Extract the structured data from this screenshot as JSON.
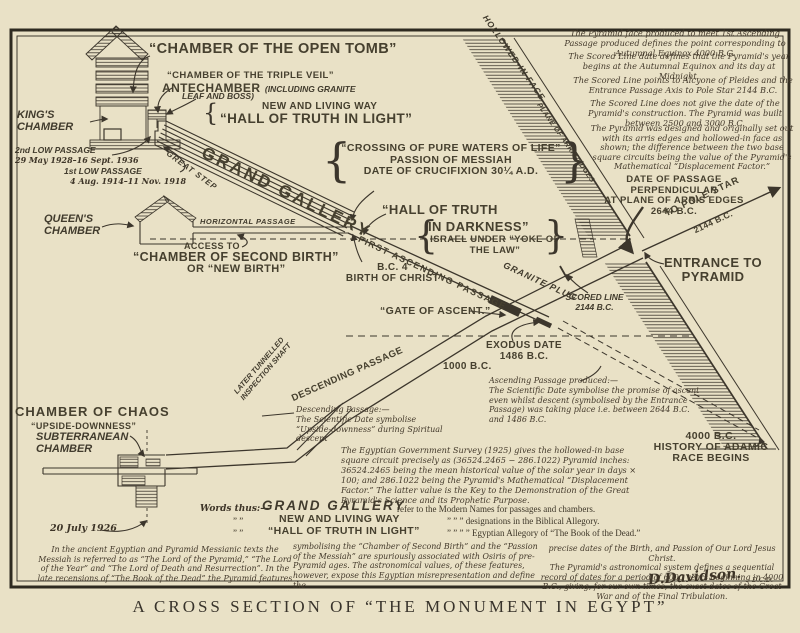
{
  "colors": {
    "paper": "#e9e1c6",
    "ink": "#3c362c"
  },
  "title": "A CROSS SECTION OF “THE MONUMENT IN EGYPT”",
  "glyphs": {
    "brace_open": "{",
    "brace_close": "}"
  },
  "labels": {
    "open_tomb": "“CHAMBER OF THE OPEN TOMB”",
    "triple_veil": "“CHAMBER OF THE TRIPLE VEIL”",
    "antechamber": "ANTECHAMBER",
    "antechamber_paren": "(INCLUDING GRANITE",
    "antechamber_paren2": "LEAF AND BOSS)",
    "new_living_way": "NEW AND LIVING WAY",
    "hall_light": "“HALL OF TRUTH IN LIGHT”",
    "kings_chamber": "KING'S\nCHAMBER",
    "low2": "2nd LOW PASSAGE",
    "low2_dates": "29 May 1928–16 Sept. 1936",
    "low1": "1st LOW PASSAGE",
    "low1_dates": "4 Aug. 1914–11 Nov. 1918",
    "great_step": "GREAT STEP",
    "grand_gallery": "GRAND GALLERY",
    "crossing": "“CROSSING OF PURE WATERS OF LIFE”\nPASSION OF MESSIAH\nDATE OF CRUCIFIXION 30¼ A.D.",
    "hollowed_face": "HOLLOWED-IN FACE",
    "plane_arris": "PLANE OF ARRIS EDGES",
    "date_perpendicular": "DATE OF PASSAGE PERPENDICULAR\nAT PLANE OF ARRIS EDGES\n2644 B.C.",
    "pole_star": "TO POLE STAR",
    "pole_star_date": "2144 B.C.",
    "entrance": "ENTRANCE TO\nPYRAMID",
    "queens_chamber": "QUEEN'S\nCHAMBER",
    "horizontal_passage": "HORIZONTAL PASSAGE",
    "access_to": "ACCESS TO",
    "second_birth": "“CHAMBER OF SECOND BIRTH”",
    "new_birth": "OR “NEW BIRTH”",
    "hall_darkness_1": "“HALL OF TRUTH",
    "hall_darkness_2": "IN DARKNESS”",
    "israel": "ISRAEL UNDER “YOKE OF\nTHE LAW”",
    "first_ascending": "FIRST ASCENDING PASSAGE",
    "bc4": "B.C. 4\nBIRTH OF CHRIST",
    "gate_of_ascent": "“GATE OF ASCENT.”",
    "granite_plug": "GRANITE PLUG",
    "scored_line": "SCORED LINE\n2144 B.C.",
    "exodus": "EXODUS DATE\n1486 B.C.",
    "bc1000": "1000 B.C.",
    "adamic": "4000 B.C.\nHISTORY OF ADAMIC\nRACE BEGINS",
    "descending_passage": "DESCENDING PASSAGE",
    "inspection_shaft": "LATER TUNNELLED\nINSPECTION SHAFT",
    "chamber_chaos": "CHAMBER OF CHAOS",
    "upside_downness": "“UPSIDE-DOWNNESS”",
    "subterranean": "SUBTERRANEAN\nCHAMBER",
    "date_1926": "20 July 1926"
  },
  "notes": {
    "n1": "The Pyramid face produced to meet 1st Ascending Passage produced defines the point corresponding to Autumnal Equinox 4000 B.C.",
    "n2": "The Scored Line date defines that the Pyramid's year begins at the Autumnal Equinox and its day at Midnight.",
    "n3": "The Scored Line points to Alcyone of Pleides and the Entrance Passage Axis to Pole Star 2144 B.C.",
    "n4": "The Scored Line does not give the date of the Pyramid's construction.  The Pyramid was built between 2500 and 3000 B.C.",
    "n5": "The Pyramid was designed and originally set out with its arris edges and hollowed-in face as shown; the difference between the two base square circuits being the value of the Pyramid's Mathematical “Displacement Factor.”",
    "ascending": "Ascending Passage produced:—\nThe Scientific Date symbolise the promise of ascent even whilst descent (symbolised by the Entrance Passage) was taking place i.e. between 2644 B.C. and 1486 B.C.",
    "descending": "Descending Passage:—\nThe Scientific Date symbolise\n“Upside-downness” during Spiritual descent",
    "survey": "The Egyptian Government Survey (1925) gives the hollowed-in base square circuit precisely as (36524.2465 − 286.1022) Pyramid inches:  36524.2465 being the mean historical value of the solar year in days × 100;  and 286.1022 being the Pyramid's Mathematical “Displacement Factor.”        The latter value is the Key to the Demonstration of the Great Pyramid's Science and its Prophetic Purpose.",
    "bottom_left": "In the ancient Egyptian and Pyramid Messianic texts the Messiah is referred to as “The Lord of the Pyramid,” “The Lord of the Year” and “The Lord of Death and Resurrection”.    In the late recensions of “The Book of the Dead” the Pyramid features",
    "bottom_mid": "symbolising the “Chamber of Second Birth” and the “Passion of the Messiah” are spuriously associated with Osiris of pre-Pyramid ages.   The astronomical values, of these features, however, expose this Egyptian misrepresentation and define the",
    "bottom_right": "precise dates of the Birth, and Passion of Our Lord Jesus Christ.\nThe Pyramid's astronomical system defines a sequential record of dates for a period of 6000 years beginning in 4000 B.C., giving, for our own times, the exact dates of the Great War and of the Final Tribulation.",
    "signature": "D.Davidson.",
    "signature_initials": "D.C.D."
  },
  "legend": {
    "intro": "Words thus:—",
    "rows": [
      {
        "ditto": "",
        "term": "GRAND GALLERY",
        "tail": "refer to the Modern Names for passages and chambers."
      },
      {
        "ditto": "”      ”",
        "term": "NEW AND LIVING WAY",
        "tail": "”    ”    ”    designations in the Biblical Allegory."
      },
      {
        "ditto": "”      ”",
        "term": "“HALL OF TRUTH IN LIGHT”",
        "tail": "”    ”    ”       ”       Egyptian Allegory of “The Book of the Dead.”"
      }
    ]
  }
}
